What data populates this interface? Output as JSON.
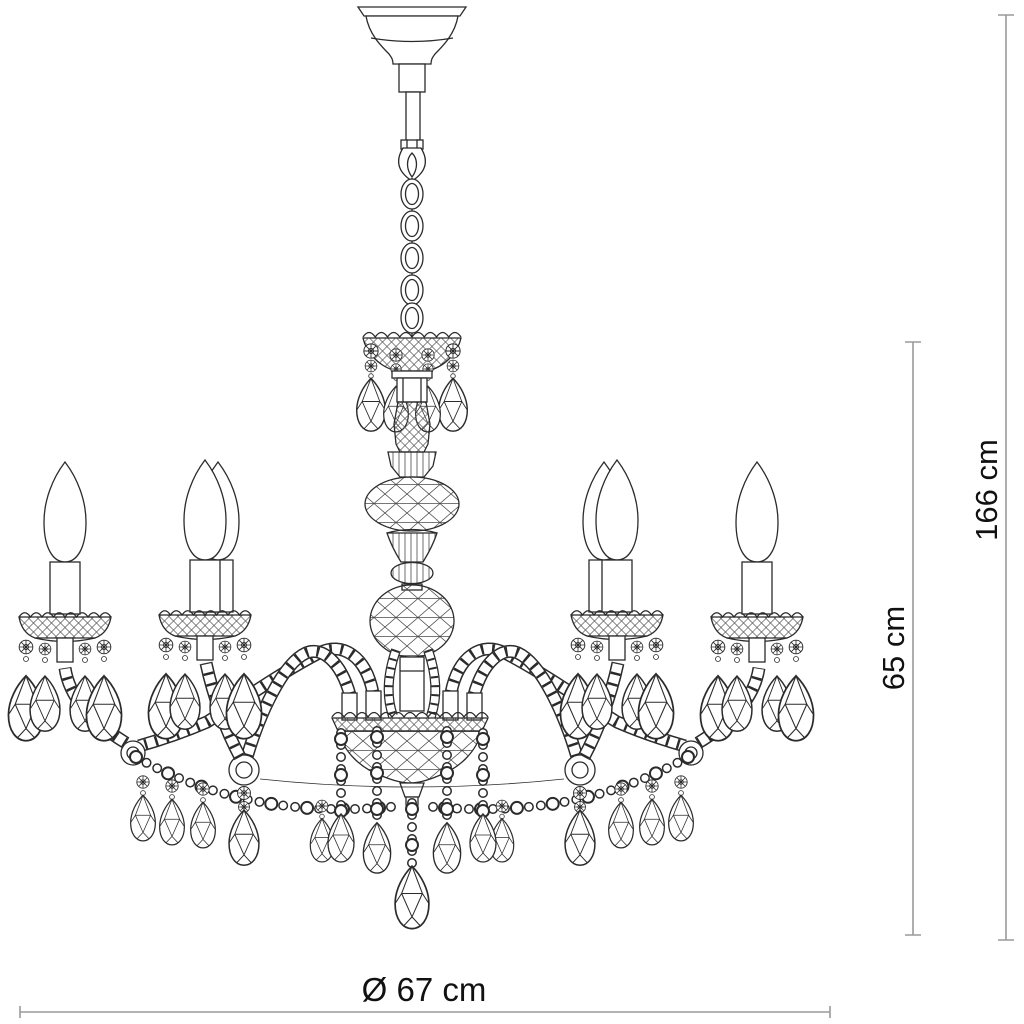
{
  "dimensions": {
    "overall_height": "166 cm",
    "fixture_height": "65 cm",
    "diameter": "Ø 67 cm"
  },
  "colors": {
    "line": "#2b2b2b",
    "dimension_line": "#9a9a9a",
    "label_text": "#111111",
    "background": "#ffffff"
  }
}
